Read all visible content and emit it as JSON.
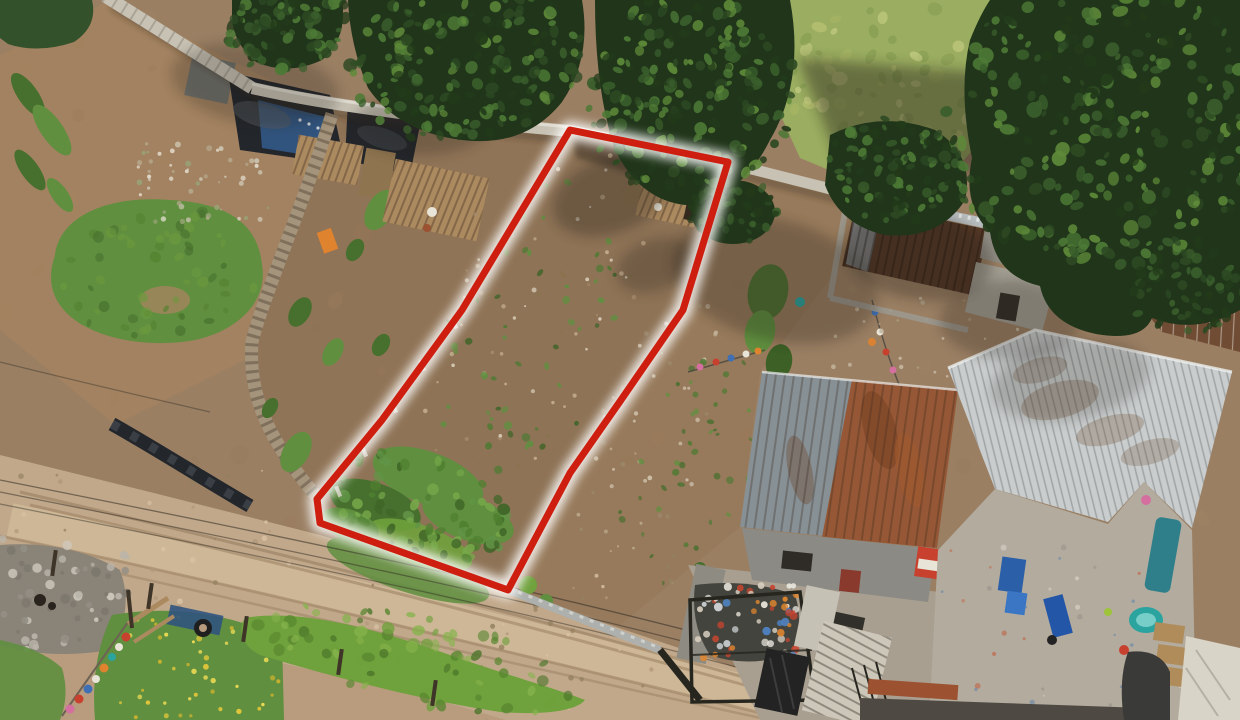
{
  "meta": {
    "description": "Aerial drone photograph of an elongated vacant dirt land plot outlined in red, between neighbor yards, with a dirt road at lower left, corrugated-metal-roof houses at right and conifer trees at top."
  },
  "palette": {
    "dirtBase": "#9a7f63",
    "dirtWarm": "#a5835f",
    "dirtPlot": "#8e7356",
    "dirtStrip": "#8a6e52",
    "dirtRight": "#957759",
    "dirtLight": "#b89c7d",
    "roadTan": "#c1a88a",
    "roadLight": "#d7c2a3",
    "trackBrown": "#9a7f61",
    "grassBright": "#6fa13c",
    "grassMid": "#5f8f3f",
    "grassDark": "#47702e",
    "grassDeep": "#3c6026",
    "grassField": "#9aad60",
    "grassYellow": "#c2c878",
    "canopyDark": "#20351a",
    "canopyMid": "#2f4f24",
    "canopyLight": "#4d7a36",
    "canopyHi": "#79a747",
    "hedge": "#33512a",
    "wallLight": "#c7c2b4",
    "wallGrey": "#b9bec0",
    "woodFence": "#a5947c",
    "woodShed": "#ac8a60",
    "woodDark": "#8e744f",
    "tarpBlack": "#23262b",
    "tarpBlue": "#31547e",
    "tarpGrey": "#70716c",
    "roofRust": "#96522d",
    "roofGrey": "#879095",
    "roofSilver": "#c9cdcd",
    "roofBrown": "#6f4c33",
    "roofDarkRust": "#553826",
    "ridgeWhite": "#eef0ef",
    "concrete": "#b2ab9e",
    "concreteLight": "#cdc7ba",
    "concreteWhite": "#c6c1b5",
    "metalDark": "#232323",
    "fenceDark": "#26261f",
    "stoneGrey": "#a7a196",
    "rubbleDark": "#8a8378",
    "flowerYellow": "#e8c93a",
    "itemRed": "#c8402e",
    "itemBlue": "#3f6fb5",
    "itemPink": "#d46fa0",
    "itemOrange": "#e0832f",
    "itemTeal": "#2ba39e",
    "itemWhite": "#e9e4d8",
    "itemLime": "#9ec43a",
    "crateBlue": "#2b5fa8",
    "bikeBlue": "#2456a8",
    "poolInner": "#7fd3cd",
    "palletTan": "#b08c5a",
    "tarpWhite": "#d9d4c8",
    "terracotta": "#9c5130",
    "darkBand": "#4e4a43",
    "trashBase": "#44443e",
    "doorRed": "#8a3a2c",
    "windowDark": "#2f2b27",
    "wire": "#2f2a22",
    "postBrown": "#3f3428",
    "tireBlack": "#1f1f1f",
    "animalDark": "#2a241e",
    "shadow": "#241c12",
    "glowWhite": "#ffffff",
    "boundaryRed": "#ce1e0f"
  },
  "boundary": {
    "name": "highlighted-plot-boundary",
    "stroke_color": "#ce1e0f",
    "stroke_width": 7,
    "glow_color": "#ffffff",
    "glow_width": 18,
    "glow_opacity": 0.85,
    "points": [
      [
        570,
        130
      ],
      [
        728,
        162
      ],
      [
        683,
        310
      ],
      [
        621,
        400
      ],
      [
        570,
        473
      ],
      [
        508,
        590
      ],
      [
        320,
        523
      ],
      [
        317,
        499
      ],
      [
        382,
        420
      ],
      [
        462,
        310
      ]
    ]
  },
  "objects": [
    {
      "name": "vacant-lot",
      "label": "red-outlined dirt plot"
    },
    {
      "name": "left-neighbor-yard",
      "label": "yard with grass patch, tarps and debris"
    },
    {
      "name": "middle-strip",
      "label": "narrow dirt strip with crop rows"
    },
    {
      "name": "right-strip",
      "label": "dirt strip with garden and clotheslines"
    },
    {
      "name": "dirt-road",
      "label": "diagonal dirt road with tire tracks"
    },
    {
      "name": "houses",
      "label": "corrugated metal roofs (rust and silver)"
    },
    {
      "name": "conifer-trees",
      "label": "dark green tree canopies"
    },
    {
      "name": "laundry-lines",
      "label": "colorful clothes on lines"
    },
    {
      "name": "rubble-pile",
      "label": "grey stone rubble"
    },
    {
      "name": "trash-pile",
      "label": "fenced corner full of bagged trash"
    }
  ],
  "texture_scatters": [
    {
      "name": "dirt-mottle",
      "target": "sc-mottle",
      "seed": 11,
      "count": 130,
      "area": {
        "type": "rect",
        "x": 0,
        "y": 0,
        "w": 1240,
        "h": 720
      },
      "colors": [
        "#8f7254",
        "#ab8a66",
        "#a37f5c"
      ],
      "rmin": 4,
      "rmax": 11,
      "opacity": 0.15,
      "stretch": true
    },
    {
      "name": "grassfield-mottle",
      "target": "sc-grassfield",
      "seed": 21,
      "count": 65,
      "area": {
        "type": "ellipse",
        "cx": 885,
        "cy": 82,
        "rx": 112,
        "ry": 82,
        "rot": 0
      },
      "colors": [
        "#aab764",
        "#d2d68c",
        "#82994e",
        "#c2c878"
      ],
      "rmin": 3,
      "rmax": 8,
      "opacity": 0.6,
      "stretch": true
    },
    {
      "name": "road-stones",
      "target": "sc-road",
      "seed": 31,
      "count": 55,
      "area": {
        "type": "rect",
        "x": 0,
        "y": 468,
        "w": 560,
        "h": 190
      },
      "colors": [
        "#d9c3a4",
        "#b1977a",
        "#93805f"
      ],
      "rmin": 1,
      "rmax": 3,
      "opacity": 0.85
    },
    {
      "name": "road-stones-2",
      "target": "sc-road",
      "seed": 32,
      "count": 45,
      "area": {
        "type": "rect",
        "x": 480,
        "y": 555,
        "w": 420,
        "h": 165
      },
      "colors": [
        "#d9c3a4",
        "#b1977a",
        "#93805f"
      ],
      "rmin": 1,
      "rmax": 3,
      "opacity": 0.85
    },
    {
      "name": "rubble-stones",
      "target": "sc-rubble",
      "seed": 41,
      "count": 55,
      "area": {
        "type": "rect",
        "x": 0,
        "y": 538,
        "w": 130,
        "h": 115
      },
      "colors": [
        "#b9b4aa",
        "#948f85",
        "#d0cabe",
        "#7d786e"
      ],
      "rmin": 2,
      "rmax": 5,
      "opacity": 0.95
    },
    {
      "name": "flowers",
      "target": "sc-flowers",
      "seed": 51,
      "count": 45,
      "area": {
        "type": "rect",
        "x": 112,
        "y": 612,
        "w": 172,
        "h": 106
      },
      "colors": [
        "#e8c93a",
        "#f2dd55",
        "#cdb32e"
      ],
      "rmin": 1.5,
      "rmax": 3,
      "opacity": 0.95
    },
    {
      "name": "verge-tufts",
      "target": "sc-verge",
      "seed": 61,
      "count": 75,
      "area": {
        "type": "ellipse",
        "cx": 420,
        "cy": 660,
        "rx": 168,
        "ry": 44,
        "rot": 12
      },
      "colors": [
        "#58862f",
        "#6fa13c",
        "#4a7429",
        "#86b34c"
      ],
      "rmin": 3,
      "rmax": 7,
      "opacity": 0.8,
      "stretch": true
    },
    {
      "name": "leftyard-grass",
      "target": "sc-lgrass",
      "seed": 71,
      "count": 60,
      "area": {
        "type": "ellipse",
        "cx": 160,
        "cy": 272,
        "rx": 102,
        "ry": 64,
        "rot": -8
      },
      "colors": [
        "#54822f",
        "#6b9a3e",
        "#47702e"
      ],
      "rmin": 3,
      "rmax": 6,
      "opacity": 0.7,
      "stretch": true
    },
    {
      "name": "leftyard-debris",
      "target": "sc-ldebris",
      "seed": 81,
      "count": 55,
      "area": {
        "type": "rect",
        "x": 138,
        "y": 138,
        "w": 130,
        "h": 84
      },
      "colors": [
        "#e8e2d4",
        "#cfc7b4",
        "#b7a98f",
        "#98a578"
      ],
      "rmin": 1,
      "rmax": 3,
      "opacity": 0.9
    },
    {
      "name": "plot-debris",
      "target": "sc-pdebris",
      "seed": 91,
      "count": 75,
      "area": {
        "type": "ellipse",
        "cx": 532,
        "cy": 318,
        "rx": 100,
        "ry": 185,
        "rot": 22
      },
      "colors": [
        "#c9b493",
        "#e0d6c2",
        "#a78d6c",
        "#8a744f"
      ],
      "rmin": 1,
      "rmax": 2.5,
      "opacity": 0.85
    },
    {
      "name": "plot-weeds",
      "target": "sc-pweeds",
      "seed": 101,
      "count": 55,
      "area": {
        "type": "ellipse",
        "cx": 535,
        "cy": 330,
        "rx": 88,
        "ry": 160,
        "rot": 22
      },
      "colors": [
        "#4e7a33",
        "#5f9040",
        "#3f6429"
      ],
      "rmin": 2,
      "rmax": 4.5,
      "opacity": 0.9,
      "stretch": true
    },
    {
      "name": "plot-grass",
      "target": "sc-pgrass",
      "seed": 111,
      "count": 85,
      "area": {
        "type": "ellipse",
        "cx": 418,
        "cy": 508,
        "rx": 95,
        "ry": 55,
        "rot": 20
      },
      "colors": [
        "#4f8030",
        "#629447",
        "#3f6527",
        "#76a84a"
      ],
      "rmin": 3,
      "rmax": 7,
      "opacity": 0.9,
      "stretch": true
    },
    {
      "name": "rightstrip-debris",
      "target": "sc-rdebris",
      "seed": 121,
      "count": 50,
      "area": {
        "type": "ellipse",
        "cx": 650,
        "cy": 430,
        "rx": 62,
        "ry": 145,
        "rot": 22
      },
      "colors": [
        "#d8cdb9",
        "#c2b197",
        "#9b8a6c"
      ],
      "rmin": 1,
      "rmax": 2.5,
      "opacity": 0.8
    },
    {
      "name": "rightstrip-weeds",
      "target": "sc-rweeds",
      "seed": 131,
      "count": 40,
      "area": {
        "type": "ellipse",
        "cx": 688,
        "cy": 468,
        "rx": 58,
        "ry": 125,
        "rot": 22
      },
      "colors": [
        "#4e7a33",
        "#5f9040",
        "#456e2e"
      ],
      "rmin": 2,
      "rmax": 4,
      "opacity": 0.85,
      "stretch": true
    },
    {
      "name": "courtyard-specks",
      "target": "sc-court",
      "seed": 141,
      "count": 35,
      "area": {
        "type": "rect",
        "x": 940,
        "y": 545,
        "w": 252,
        "h": 168
      },
      "colors": [
        "#d9d4c8",
        "#98928a",
        "#c0694a",
        "#6b88a8"
      ],
      "rmin": 1,
      "rmax": 3,
      "opacity": 0.7
    },
    {
      "name": "yardtop-specks",
      "target": "sc-yardtop",
      "seed": 151,
      "count": 30,
      "area": {
        "type": "rect",
        "x": 828,
        "y": 298,
        "w": 225,
        "h": 85
      },
      "colors": [
        "#d8cdb9",
        "#b3a68e"
      ],
      "rmin": 1,
      "rmax": 2.5,
      "opacity": 0.7
    },
    {
      "name": "trash-bits",
      "target": "sc-trash",
      "seed": 161,
      "count": 60,
      "area": {
        "type": "rect",
        "x": 697,
        "y": 585,
        "w": 102,
        "h": 74
      },
      "colors": [
        "#e9e6dd",
        "#cfd3d6",
        "#e0862f",
        "#4f84c4",
        "#c8452f",
        "#d9cfc0"
      ],
      "rmin": 2,
      "rmax": 4.5,
      "opacity": 0.95
    },
    {
      "name": "canopy-1",
      "target": "sc-t1",
      "seed": 171,
      "count": 90,
      "area": {
        "type": "ellipse",
        "cx": 290,
        "cy": 28,
        "rx": 64,
        "ry": 42,
        "rot": -10
      },
      "colors": [
        "#2d4a23",
        "#3a5e2c",
        "#4d7a36",
        "#223a1a"
      ],
      "rmin": 3,
      "rmax": 7,
      "opacity": 0.95,
      "stretch": true
    },
    {
      "name": "canopy-2",
      "target": "sc-t2",
      "seed": 181,
      "count": 190,
      "area": {
        "type": "ellipse",
        "cx": 465,
        "cy": 62,
        "rx": 118,
        "ry": 80,
        "rot": -8
      },
      "colors": [
        "#2d4a23",
        "#3a5e2c",
        "#4d7a36",
        "#223a1a",
        "#5e8a39"
      ],
      "rmin": 3,
      "rmax": 7,
      "opacity": 0.95,
      "stretch": true
    },
    {
      "name": "canopy-3",
      "target": "sc-t3",
      "seed": 191,
      "count": 190,
      "area": {
        "type": "ellipse",
        "cx": 690,
        "cy": 95,
        "rx": 108,
        "ry": 102,
        "rot": 0
      },
      "colors": [
        "#2d4a23",
        "#3a5e2c",
        "#4d7a36",
        "#223a1a",
        "#5e8a39"
      ],
      "rmin": 3,
      "rmax": 7,
      "opacity": 0.95,
      "stretch": true
    },
    {
      "name": "canopy-3-branch",
      "target": "sc-t3b",
      "seed": 201,
      "count": 55,
      "area": {
        "type": "ellipse",
        "cx": 733,
        "cy": 212,
        "rx": 44,
        "ry": 34,
        "rot": 0
      },
      "colors": [
        "#2d4a23",
        "#3a5e2c",
        "#223a1a"
      ],
      "rmin": 3,
      "rmax": 6,
      "opacity": 0.95,
      "stretch": true
    },
    {
      "name": "canopy-4",
      "target": "sc-t4",
      "seed": 211,
      "count": 95,
      "area": {
        "type": "ellipse",
        "cx": 900,
        "cy": 172,
        "rx": 74,
        "ry": 54,
        "rot": 15
      },
      "colors": [
        "#2d4a23",
        "#3a5e2c",
        "#4d7a36",
        "#223a1a"
      ],
      "rmin": 3,
      "rmax": 6,
      "opacity": 0.95,
      "stretch": true
    },
    {
      "name": "canopy-5",
      "target": "sc-t5",
      "seed": 221,
      "count": 280,
      "area": {
        "type": "ellipse",
        "cx": 1105,
        "cy": 125,
        "rx": 168,
        "ry": 142,
        "rot": 0
      },
      "colors": [
        "#2d4a23",
        "#3a5e2c",
        "#4d7a36",
        "#223a1a",
        "#5e8a39"
      ],
      "rmin": 3,
      "rmax": 8,
      "opacity": 0.95,
      "stretch": true
    },
    {
      "name": "canopy-5-lobe",
      "target": "sc-t5b",
      "seed": 231,
      "count": 70,
      "area": {
        "type": "ellipse",
        "cx": 1185,
        "cy": 285,
        "rx": 62,
        "ry": 48,
        "rot": 0
      },
      "colors": [
        "#2d4a23",
        "#3a5e2c",
        "#223a1a"
      ],
      "rmin": 3,
      "rmax": 6,
      "opacity": 0.95,
      "stretch": true
    }
  ]
}
